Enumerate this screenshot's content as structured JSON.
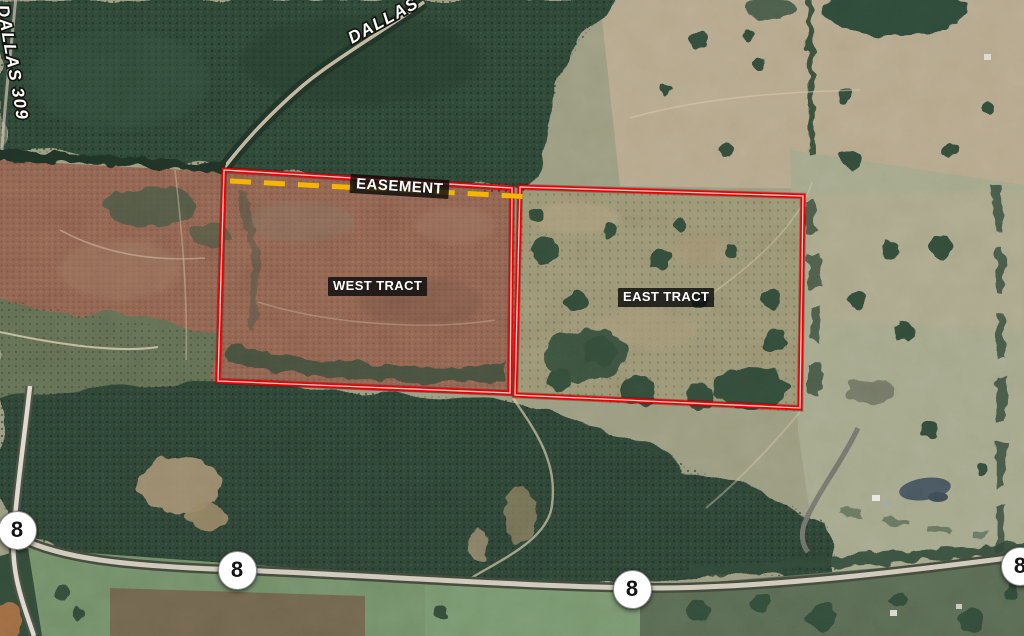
{
  "map": {
    "road_labels": [
      {
        "id": "dallas-309",
        "text": "DALLAS 309"
      },
      {
        "id": "dallas",
        "text": "DALLAS"
      }
    ],
    "tracts": [
      {
        "id": "west",
        "label": "WEST TRACT"
      },
      {
        "id": "east",
        "label": "EAST TRACT"
      }
    ],
    "easement": {
      "label": "EASEMENT"
    },
    "highway_shields": [
      {
        "route": "8"
      },
      {
        "route": "8"
      },
      {
        "route": "8"
      },
      {
        "route": "8"
      }
    ],
    "colors": {
      "tract_outline": "#ec0000",
      "easement_dash": "#f5b501",
      "shield_bg": "#ffffff",
      "shield_text": "#141414",
      "label_bg": "#111111",
      "label_text": "#ffffff"
    }
  }
}
